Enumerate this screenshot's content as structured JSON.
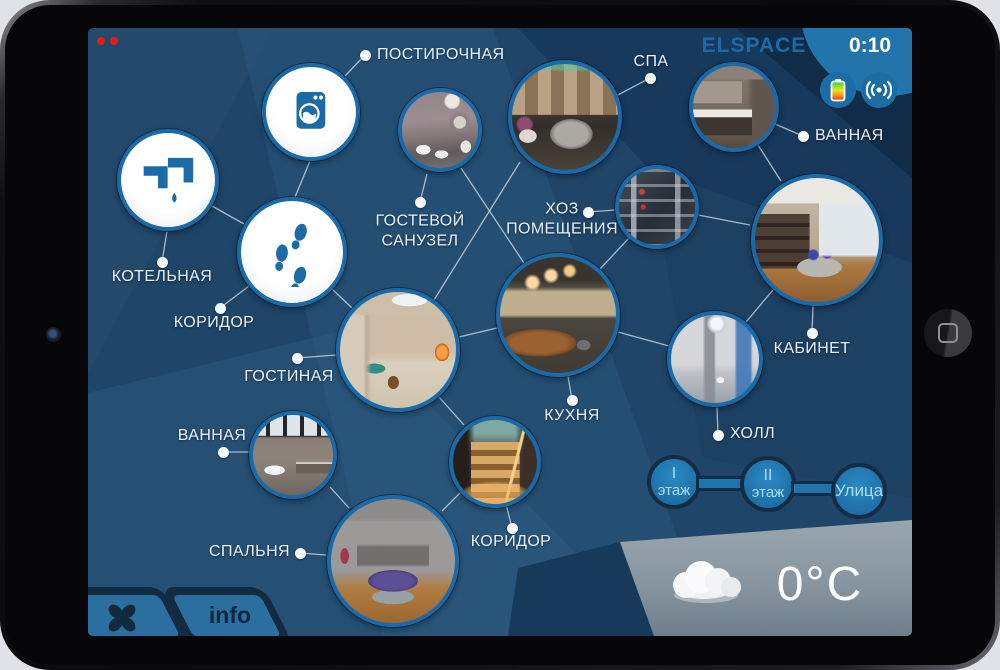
{
  "header": {
    "logo": "ELSPACE",
    "timer": "0:10"
  },
  "weather": {
    "temperature": "0°C"
  },
  "footer": {
    "info_label": "info"
  },
  "colors": {
    "accent_blue": "#1c6ba6",
    "background_navy": "#1f4568",
    "button_blue": "#2b6f9e",
    "dark_outline": "#132c44",
    "logo_blue": "#1d6ba6",
    "label_white": "#e9f1f7"
  },
  "status_icons": [
    {
      "id": "battery",
      "icon": "battery-icon"
    },
    {
      "id": "wireless",
      "icon": "wireless-signal-icon"
    }
  ],
  "floor_buttons": [
    {
      "id": "floor-1",
      "lines": [
        "I",
        "этаж"
      ],
      "x": 586,
      "y": 454,
      "r": 27
    },
    {
      "id": "floor-2",
      "lines": [
        "II",
        "этаж"
      ],
      "x": 680,
      "y": 456,
      "r": 28
    },
    {
      "id": "street",
      "lines": [
        "Улица"
      ],
      "x": 771,
      "y": 463,
      "r": 28
    }
  ],
  "rooms": [
    {
      "id": "postirochnaya",
      "label": "ПОСТИРОЧНАЯ",
      "kind": "icon",
      "icon": "washer",
      "circle": {
        "x": 223,
        "y": 84,
        "r": 49
      },
      "dot": {
        "x": 277,
        "y": 27
      },
      "label_pos": {
        "x": 289,
        "y": 27
      },
      "label_align": "left"
    },
    {
      "id": "kotelnaya",
      "label": "КОТЕЛЬНАЯ",
      "kind": "icon",
      "icon": "faucet",
      "circle": {
        "x": 80,
        "y": 152,
        "r": 51
      },
      "dot": {
        "x": 74,
        "y": 234
      },
      "label_pos": {
        "x": 74,
        "y": 249
      },
      "label_align": "center"
    },
    {
      "id": "koridor-upper",
      "label": "КОРИДОР",
      "kind": "icon",
      "icon": "footprints",
      "circle": {
        "x": 204,
        "y": 224,
        "r": 55
      },
      "dot": {
        "x": 132,
        "y": 280
      },
      "label_pos": {
        "x": 126,
        "y": 295
      },
      "label_align": "center"
    },
    {
      "id": "gostevoy-sanuzel",
      "label": "ГОСТЕВОЙ\nСАНУЗЕЛ",
      "kind": "photo",
      "photo": "ph-guest",
      "circle": {
        "x": 352,
        "y": 102,
        "r": 42
      },
      "dot": {
        "x": 332,
        "y": 174
      },
      "label_pos": {
        "x": 332,
        "y": 203
      },
      "label_align": "center"
    },
    {
      "id": "spa",
      "label": "СПА",
      "kind": "photo",
      "photo": "ph-spa",
      "circle": {
        "x": 477,
        "y": 89,
        "r": 57
      },
      "dot": {
        "x": 562,
        "y": 50
      },
      "label_pos": {
        "x": 563,
        "y": 34
      },
      "label_align": "center"
    },
    {
      "id": "vannaya-upper",
      "label": "ВАННАЯ",
      "kind": "photo",
      "photo": "ph-bath2",
      "circle": {
        "x": 646,
        "y": 79,
        "r": 45
      },
      "dot": {
        "x": 715,
        "y": 108
      },
      "label_pos": {
        "x": 727,
        "y": 108
      },
      "label_align": "left"
    },
    {
      "id": "hoz-pomescheniya",
      "label": "ХОЗ\nПОМЕЩЕНИЯ",
      "kind": "photo",
      "photo": "ph-rack",
      "circle": {
        "x": 569,
        "y": 179,
        "r": 42
      },
      "dot": {
        "x": 500,
        "y": 184
      },
      "label_pos": {
        "x": 474,
        "y": 191
      },
      "label_align": "center"
    },
    {
      "id": "kabinet",
      "label": "КАБИНЕТ",
      "kind": "photo",
      "photo": "ph-office",
      "circle": {
        "x": 729,
        "y": 212,
        "r": 66
      },
      "dot": {
        "x": 724,
        "y": 305
      },
      "label_pos": {
        "x": 724,
        "y": 321
      },
      "label_align": "center"
    },
    {
      "id": "gostinaya",
      "label": "ГОСТИНАЯ",
      "kind": "photo",
      "photo": "ph-living",
      "circle": {
        "x": 310,
        "y": 322,
        "r": 62
      },
      "dot": {
        "x": 209,
        "y": 330
      },
      "label_pos": {
        "x": 201,
        "y": 349
      },
      "label_align": "center"
    },
    {
      "id": "kuhnya",
      "label": "КУХНЯ",
      "kind": "photo",
      "photo": "ph-kitchen",
      "circle": {
        "x": 470,
        "y": 287,
        "r": 62
      },
      "dot": {
        "x": 484,
        "y": 372
      },
      "label_pos": {
        "x": 484,
        "y": 388
      },
      "label_align": "center"
    },
    {
      "id": "holl",
      "label": "ХОЛЛ",
      "kind": "photo",
      "photo": "ph-hall",
      "circle": {
        "x": 627,
        "y": 331,
        "r": 48
      },
      "dot": {
        "x": 630,
        "y": 407
      },
      "label_pos": {
        "x": 642,
        "y": 406
      },
      "label_align": "left"
    },
    {
      "id": "vannaya-lower",
      "label": "ВАННАЯ",
      "kind": "photo",
      "photo": "ph-bath1",
      "circle": {
        "x": 205,
        "y": 427,
        "r": 44
      },
      "dot": {
        "x": 135,
        "y": 424
      },
      "label_pos": {
        "x": 124,
        "y": 408
      },
      "label_align": "center"
    },
    {
      "id": "spalnya",
      "label": "СПАЛЬНЯ",
      "kind": "photo",
      "photo": "ph-bedroom",
      "circle": {
        "x": 305,
        "y": 533,
        "r": 66
      },
      "dot": {
        "x": 212,
        "y": 525
      },
      "label_pos": {
        "x": 202,
        "y": 524
      },
      "label_align": "right"
    },
    {
      "id": "koridor-lower",
      "label": "КОРИДОР",
      "kind": "photo",
      "photo": "ph-stairs",
      "circle": {
        "x": 407,
        "y": 434,
        "r": 46
      },
      "dot": {
        "x": 424,
        "y": 500
      },
      "label_pos": {
        "x": 423,
        "y": 514
      },
      "label_align": "center"
    }
  ],
  "lines": [
    [
      277,
      27,
      257,
      48
    ],
    [
      222,
      133,
      207,
      169
    ],
    [
      79,
      203,
      74,
      234
    ],
    [
      124,
      178,
      156,
      196
    ],
    [
      161,
      258,
      132,
      280
    ],
    [
      339,
      146,
      332,
      174
    ],
    [
      562,
      50,
      528,
      68
    ],
    [
      715,
      108,
      687,
      96
    ],
    [
      670,
      117,
      693,
      153
    ],
    [
      500,
      184,
      527,
      182
    ],
    [
      432,
      134,
      346,
      272
    ],
    [
      541,
      210,
      512,
      241
    ],
    [
      610,
      187,
      662,
      197
    ],
    [
      373,
      140,
      436,
      235
    ],
    [
      244,
      261,
      264,
      280
    ],
    [
      209,
      330,
      248,
      327
    ],
    [
      371,
      309,
      409,
      300
    ],
    [
      480,
      348,
      484,
      372
    ],
    [
      530,
      304,
      581,
      318
    ],
    [
      629,
      379,
      630,
      407
    ],
    [
      658,
      294,
      685,
      262
    ],
    [
      725,
      278,
      724,
      305
    ],
    [
      135,
      424,
      166,
      424
    ],
    [
      242,
      459,
      261,
      480
    ],
    [
      212,
      525,
      238,
      527
    ],
    [
      354,
      483,
      373,
      464
    ],
    [
      418,
      476,
      424,
      500
    ],
    [
      351,
      369,
      376,
      397
    ],
    [
      772,
      29,
      757,
      47
    ],
    [
      800,
      32,
      793,
      45
    ]
  ]
}
